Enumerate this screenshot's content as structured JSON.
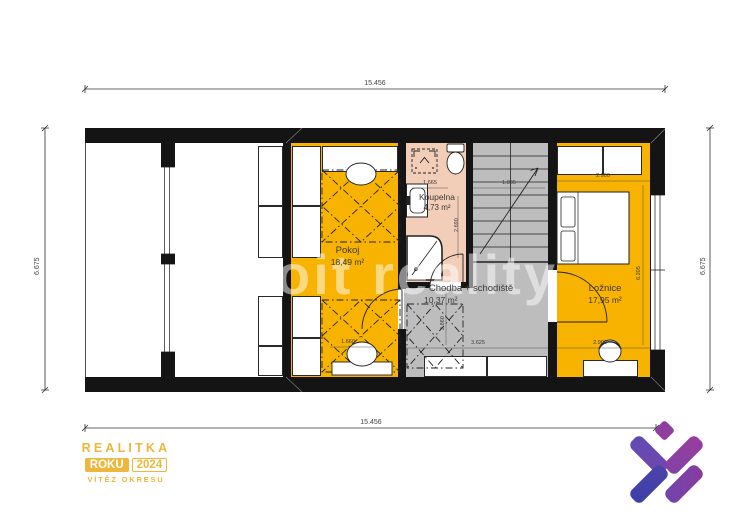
{
  "plan": {
    "watermark": "oit reality",
    "rooms": {
      "pokoj": {
        "name": "Pokoj",
        "area": "18,49 m²"
      },
      "koupelna": {
        "name": "Koupelna",
        "area": "4,73 m²"
      },
      "chodba": {
        "name": "Chodba + schodiště",
        "area": "10,37 m²"
      },
      "loznice": {
        "name": "Ložnice",
        "area": "17,95 m²"
      }
    },
    "outer_dims": {
      "top": "15.456",
      "bottom": "15.456",
      "left": "6.675",
      "right": "6.675"
    },
    "inner_dims": {
      "koupelna_width": "1.665",
      "schodiste_width": "1.835",
      "loznice_top": "2.900",
      "loznice_bottom": "2.900",
      "koupelna_height": "2.690",
      "chodba_height": "2.860",
      "chodba_width": "3.625",
      "loznice_height": "6.205",
      "pokoj_bed_width": "1.660"
    }
  },
  "branding": {
    "award": {
      "title": "REALITKA",
      "chip": "ROKU",
      "year": "2024",
      "subtitle": "VÍTĚZ OKRESU",
      "color": "#EDB63C"
    },
    "logo_colors": {
      "diamond": "#8F3E9E",
      "bar_top_left": "#5F4BB4",
      "bar_top_right": "#9C3C9E",
      "bar_bottom_left": "#3A3FA6",
      "bar_bottom_right": "#6F45AD"
    }
  },
  "colors": {
    "room_yellow": "#F8B301",
    "bathroom_pink": "#F2CDB8",
    "hallway_gray": "#BDBDBD",
    "wall_black": "#141414"
  }
}
